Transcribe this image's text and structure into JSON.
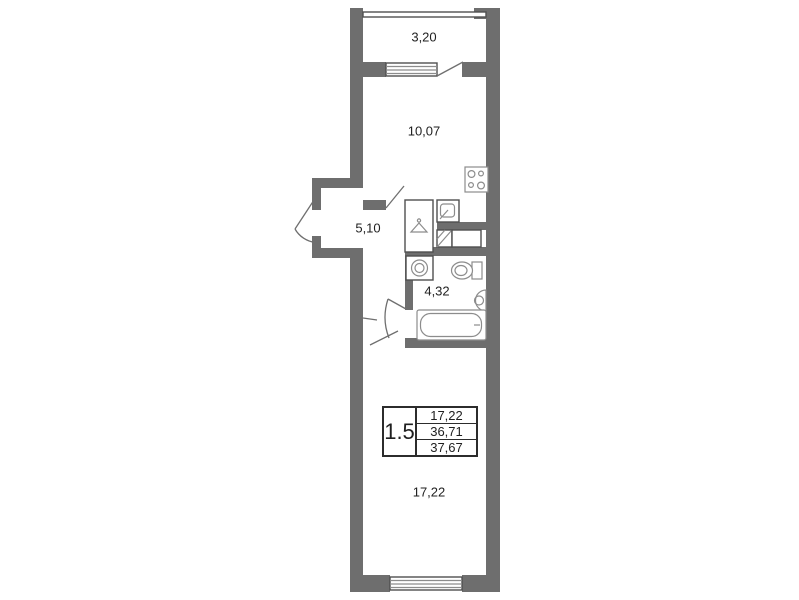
{
  "plan": {
    "title": "Apartment floor plan",
    "rooms": {
      "balcony": "3,20",
      "kitchen": "10,07",
      "hall": "5,10",
      "bathroom": "4,32",
      "room": "17,22"
    },
    "info_table": {
      "rooms_count": "1.5",
      "rows": [
        "17,22",
        "36,71",
        "37,67"
      ]
    },
    "fixtures": [
      "stove",
      "kitchen-sink",
      "wardrobe",
      "washing-machine",
      "toilet",
      "wash-basin",
      "bathtub",
      "ventilation-shaft"
    ],
    "colors": {
      "wall": "#6e6e6e",
      "line": "#4f4f4f",
      "fixture_line": "#8c8c8c",
      "text": "#1f1f1f",
      "background": "#ffffff"
    }
  }
}
